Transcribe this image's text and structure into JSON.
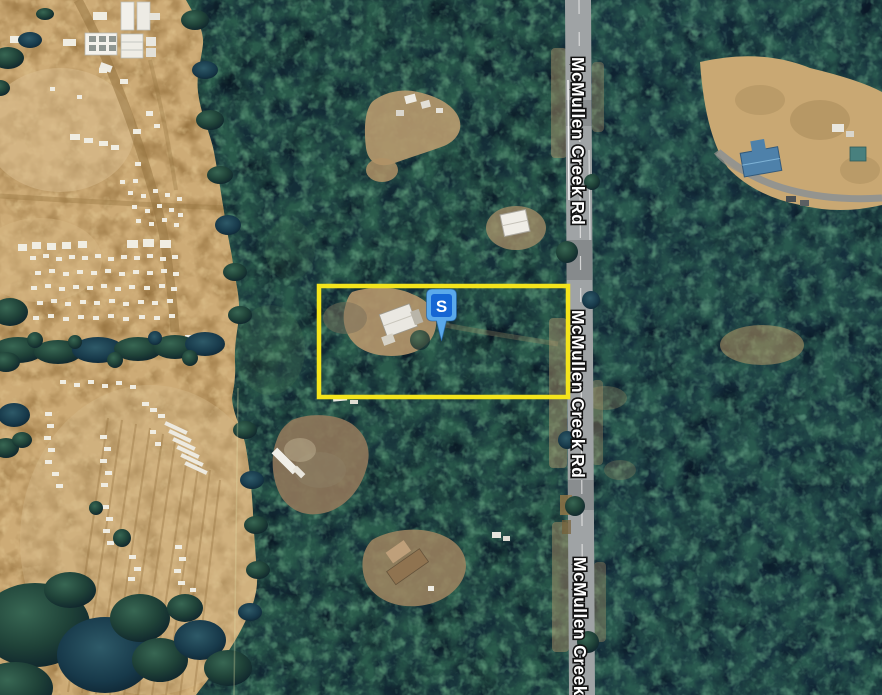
{
  "map": {
    "view_type": "satellite",
    "road": {
      "name": "McMullen Creek Rd",
      "labels": [
        "McMullen Creek Rd",
        "McMullen Creek Rd",
        "McMullen Creek Rd"
      ],
      "surface_color": "#9FA3A5"
    },
    "marker": {
      "letter": "S",
      "balloon_color": "#5AA9EB",
      "badge_color": "#1566D4",
      "letter_color": "#FFFFFF"
    },
    "parcel": {
      "outline_color": "#F4E41C"
    },
    "terrain": {
      "forest_base": "#142C38",
      "farmland": "#CDAB76"
    }
  }
}
